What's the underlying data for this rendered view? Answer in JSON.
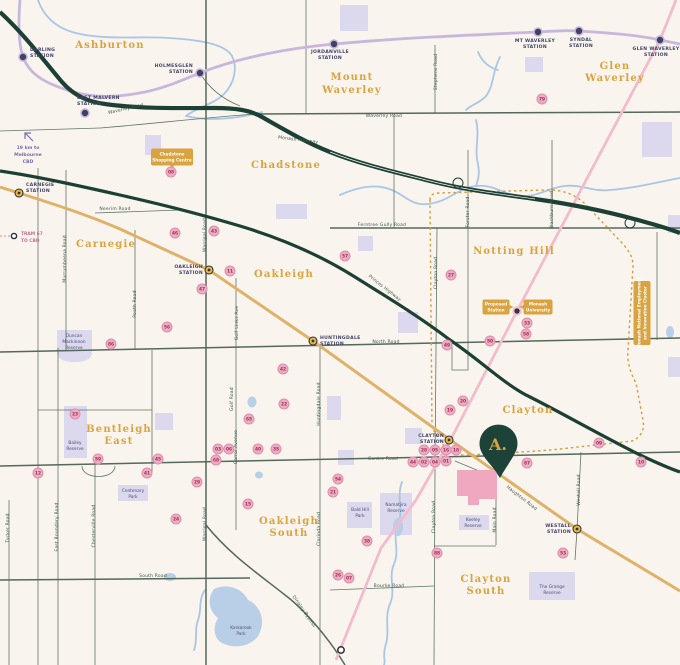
{
  "map": {
    "pin": {
      "label": "A."
    },
    "colors": {
      "background": "#f9f4ee",
      "freeway": "#1c4034",
      "minor_road": "#44604f",
      "gold_rail": "#dfb269",
      "purple_rail": "#c8b7db",
      "pink_line": "#f2bccd",
      "dotted_boundary": "#cf9e3d",
      "water": "#a9c7e5",
      "reserve": "#dcd8ed",
      "marker_fill": "#ecadc2",
      "marker_text": "#9e2f56",
      "badge": "#d9a340",
      "suburb_text": "#d9a43e",
      "station_text": "#3f4366",
      "pin_fill": "#1d4338"
    },
    "suburbs": [
      {
        "lines": [
          "Ashburton"
        ],
        "x": 110,
        "ys": [
          48
        ]
      },
      {
        "lines": [
          "Mount",
          "Waverley"
        ],
        "x": 352,
        "ys": [
          80,
          93
        ]
      },
      {
        "lines": [
          "Glen",
          "Waverley"
        ],
        "x": 615,
        "ys": [
          69,
          81
        ]
      },
      {
        "lines": [
          "Chadstone"
        ],
        "x": 286,
        "ys": [
          168
        ]
      },
      {
        "lines": [
          "Carnegie"
        ],
        "x": 106,
        "ys": [
          247
        ]
      },
      {
        "lines": [
          "Oakleigh"
        ],
        "x": 284,
        "ys": [
          277
        ]
      },
      {
        "lines": [
          "Notting Hill"
        ],
        "x": 514,
        "ys": [
          254
        ]
      },
      {
        "lines": [
          "Clayton"
        ],
        "x": 528,
        "ys": [
          413
        ]
      },
      {
        "lines": [
          "Bentleigh",
          "East"
        ],
        "x": 119,
        "ys": [
          432,
          444
        ]
      },
      {
        "lines": [
          "Oakleigh",
          "South"
        ],
        "x": 289,
        "ys": [
          524,
          536
        ]
      },
      {
        "lines": [
          "Clayton",
          "South"
        ],
        "x": 486,
        "ys": [
          582,
          594
        ]
      }
    ],
    "stations": [
      {
        "lines": [
          "DARLING",
          "STATION"
        ],
        "x": 23,
        "y": 57,
        "type": "purple",
        "anchor": "start",
        "lx": 30,
        "lys": [
          51,
          57
        ]
      },
      {
        "lines": [
          "EAST MALVERN",
          "STATION"
        ],
        "x": 85,
        "y": 113,
        "type": "purple",
        "anchor": "start",
        "lx": 77,
        "lys": [
          99,
          105
        ]
      },
      {
        "lines": [
          "HOLMESGLEN",
          "STATION"
        ],
        "x": 200,
        "y": 73,
        "type": "purple",
        "anchor": "end",
        "lx": 193,
        "lys": [
          67,
          73
        ]
      },
      {
        "lines": [
          "JORDANVILLE",
          "STATION"
        ],
        "x": 334,
        "y": 44,
        "type": "purple",
        "anchor": "middle",
        "lx": 330,
        "lys": [
          53,
          59
        ]
      },
      {
        "lines": [
          "MT WAVERLEY",
          "STATION"
        ],
        "x": 538,
        "y": 32,
        "type": "purple",
        "anchor": "middle",
        "lx": 535,
        "lys": [
          42,
          48
        ]
      },
      {
        "lines": [
          "SYNDAL",
          "STATION"
        ],
        "x": 579,
        "y": 31,
        "type": "purple",
        "anchor": "middle",
        "lx": 581,
        "lys": [
          41,
          47
        ]
      },
      {
        "lines": [
          "GLEN WAVERLEY",
          "STATION"
        ],
        "x": 660,
        "y": 40,
        "type": "purple",
        "anchor": "middle",
        "lx": 656,
        "lys": [
          50,
          56
        ]
      },
      {
        "lines": [
          "CARNEGIE",
          "STATION"
        ],
        "x": 19,
        "y": 193,
        "type": "gold",
        "anchor": "start",
        "lx": 26,
        "lys": [
          186,
          192
        ]
      },
      {
        "lines": [
          "OAKLEIGH",
          "STATION"
        ],
        "x": 209,
        "y": 270,
        "type": "gold",
        "anchor": "end",
        "lx": 203,
        "lys": [
          268,
          274
        ]
      },
      {
        "lines": [
          "HUNTINGDALE",
          "STATION"
        ],
        "x": 313,
        "y": 341,
        "type": "gold",
        "anchor": "start",
        "lx": 320,
        "lys": [
          339,
          345
        ]
      },
      {
        "lines": [
          "CLAYTON",
          "STATION"
        ],
        "x": 449,
        "y": 440,
        "type": "gold",
        "anchor": "end",
        "lx": 444,
        "lys": [
          437,
          443
        ]
      },
      {
        "lines": [
          "WESTALL",
          "STATION"
        ],
        "x": 577,
        "y": 529,
        "type": "gold",
        "anchor": "end",
        "lx": 571,
        "lys": [
          527,
          533
        ]
      },
      {
        "lines": [],
        "x": 517,
        "y": 311,
        "type": "proposed",
        "anchor": "start",
        "lx": 0,
        "lys": []
      }
    ],
    "badges": [
      {
        "lines": [
          "Chadstone",
          "Shopping Centre"
        ],
        "cx": 172,
        "cy": 157,
        "w": 42,
        "h": 17,
        "vertical": false,
        "pointer": "down"
      },
      {
        "lines": [
          "Proposed",
          "Station"
        ],
        "cx": 496,
        "cy": 307,
        "w": 27,
        "h": 15,
        "vertical": false,
        "pointer": "right"
      },
      {
        "lines": [
          "Monash",
          "University"
        ],
        "cx": 538,
        "cy": 307,
        "w": 29,
        "h": 15,
        "vertical": false,
        "pointer": "left"
      },
      {
        "lines": [
          "Monash National Employment",
          "and Innovation Cluster"
        ],
        "cx": 642,
        "cy": 313,
        "w": 64,
        "h": 17,
        "vertical": true,
        "pointer": "none"
      }
    ],
    "road_labels": [
      {
        "t": "Waverley Road",
        "x": 126,
        "y": 110,
        "r": -13
      },
      {
        "t": "Waverley Road",
        "x": 384,
        "y": 117,
        "r": 0
      },
      {
        "t": "Monash Freeway",
        "x": 298,
        "y": 141,
        "r": 7
      },
      {
        "t": "Stephens Road",
        "x": 437,
        "y": 72,
        "r": -90
      },
      {
        "t": "Neerim Road",
        "x": 115,
        "y": 210,
        "r": 0
      },
      {
        "t": "Murrumbeena Road",
        "x": 66,
        "y": 259,
        "r": -90
      },
      {
        "t": "Poath Road",
        "x": 136,
        "y": 304,
        "r": -90
      },
      {
        "t": "Warrigal Road",
        "x": 206,
        "y": 235,
        "r": -90
      },
      {
        "t": "Warrigal Road",
        "x": 206,
        "y": 524,
        "r": -90
      },
      {
        "t": "Golf Links Ave",
        "x": 238,
        "y": 323,
        "r": -90
      },
      {
        "t": "Golf Road",
        "x": 233,
        "y": 399,
        "r": -90
      },
      {
        "t": "Carrol Avenue",
        "x": 237,
        "y": 447,
        "r": -90
      },
      {
        "t": "Ferntree Gully Road",
        "x": 382,
        "y": 226,
        "r": 0
      },
      {
        "t": "Forster Road",
        "x": 469,
        "y": 212,
        "r": -90
      },
      {
        "t": "Blackburn Road",
        "x": 553,
        "y": 210,
        "r": -90
      },
      {
        "t": "Clayton Road",
        "x": 437,
        "y": 273,
        "r": -90
      },
      {
        "t": "Clayton Road",
        "x": 435,
        "y": 517,
        "r": -90
      },
      {
        "t": "Princes Highway",
        "x": 384,
        "y": 289,
        "r": 38
      },
      {
        "t": "North Road",
        "x": 386,
        "y": 343,
        "r": 0
      },
      {
        "t": "Huntingdale Road",
        "x": 320,
        "y": 404,
        "r": -90
      },
      {
        "t": "Centre Road",
        "x": 383,
        "y": 460,
        "r": 0
      },
      {
        "t": "Haughton Road",
        "x": 521,
        "y": 499,
        "r": 38
      },
      {
        "t": "Main Road",
        "x": 496,
        "y": 520,
        "r": -90
      },
      {
        "t": "Westall Road",
        "x": 580,
        "y": 490,
        "r": -90
      },
      {
        "t": "Bourke Road",
        "x": 389,
        "y": 587,
        "r": 0
      },
      {
        "t": "South Road",
        "x": 153,
        "y": 577,
        "r": 0
      },
      {
        "t": "Tucker Road",
        "x": 9,
        "y": 528,
        "r": -90
      },
      {
        "t": "East Boundary Road",
        "x": 58,
        "y": 527,
        "r": -90
      },
      {
        "t": "Chesterville Road",
        "x": 95,
        "y": 526,
        "r": -90
      },
      {
        "t": "Clarinda Road",
        "x": 320,
        "y": 529,
        "r": -90
      },
      {
        "t": "Dingley Bypass",
        "x": 303,
        "y": 612,
        "r": 55
      }
    ],
    "reserves": [
      {
        "lines": [
          "Duncan",
          "Mackinnon",
          "Reserve"
        ],
        "x": 74,
        "ys": [
          337,
          343,
          349
        ]
      },
      {
        "lines": [
          "Bailey",
          "Reserve"
        ],
        "x": 75,
        "ys": [
          444,
          450
        ]
      },
      {
        "lines": [
          "Centenary",
          "Park"
        ],
        "x": 133,
        "ys": [
          492,
          498
        ]
      },
      {
        "lines": [
          "Karkarook",
          "Park"
        ],
        "x": 241,
        "ys": [
          629,
          635
        ]
      },
      {
        "lines": [
          "Bald Hill",
          "Park"
        ],
        "x": 360,
        "ys": [
          511,
          517
        ]
      },
      {
        "lines": [
          "Namatjira",
          "Reserve"
        ],
        "x": 396,
        "ys": [
          506,
          512
        ]
      },
      {
        "lines": [
          "Keeley",
          "Reserve"
        ],
        "x": 473,
        "ys": [
          521,
          527
        ]
      },
      {
        "lines": [
          "The Grange",
          "Reserve"
        ],
        "x": 552,
        "ys": [
          588,
          594
        ]
      }
    ],
    "notes": {
      "cbd": {
        "lines": [
          "19 km to",
          "Melbourne",
          "CBD"
        ],
        "x": 28,
        "ys": [
          149,
          156,
          163
        ]
      },
      "tram": {
        "lines": [
          "TRAM 67",
          "TO CBD"
        ],
        "x": 21,
        "ys": [
          235,
          242
        ]
      }
    },
    "markers": [
      {
        "n": "08",
        "x": 171,
        "y": 172
      },
      {
        "n": "79",
        "x": 542,
        "y": 99
      },
      {
        "n": "46",
        "x": 175,
        "y": 233
      },
      {
        "n": "43",
        "x": 214,
        "y": 231
      },
      {
        "n": "11",
        "x": 230,
        "y": 271
      },
      {
        "n": "47",
        "x": 202,
        "y": 289
      },
      {
        "n": "56",
        "x": 167,
        "y": 327
      },
      {
        "n": "86",
        "x": 111,
        "y": 344
      },
      {
        "n": "57",
        "x": 345,
        "y": 256
      },
      {
        "n": "27",
        "x": 451,
        "y": 275
      },
      {
        "n": "33",
        "x": 527,
        "y": 323
      },
      {
        "n": "58",
        "x": 526,
        "y": 334
      },
      {
        "n": "50",
        "x": 490,
        "y": 341
      },
      {
        "n": "49",
        "x": 447,
        "y": 345
      },
      {
        "n": "42",
        "x": 283,
        "y": 369
      },
      {
        "n": "22",
        "x": 284,
        "y": 404
      },
      {
        "n": "65",
        "x": 249,
        "y": 419
      },
      {
        "n": "23",
        "x": 75,
        "y": 414
      },
      {
        "n": "59",
        "x": 98,
        "y": 459
      },
      {
        "n": "45",
        "x": 158,
        "y": 459
      },
      {
        "n": "03",
        "x": 218,
        "y": 449
      },
      {
        "n": "06",
        "x": 229,
        "y": 449
      },
      {
        "n": "68",
        "x": 216,
        "y": 460
      },
      {
        "n": "40",
        "x": 258,
        "y": 449
      },
      {
        "n": "35",
        "x": 276,
        "y": 449
      },
      {
        "n": "12",
        "x": 38,
        "y": 473
      },
      {
        "n": "41",
        "x": 147,
        "y": 473
      },
      {
        "n": "29",
        "x": 197,
        "y": 482
      },
      {
        "n": "24",
        "x": 176,
        "y": 519
      },
      {
        "n": "15",
        "x": 248,
        "y": 504
      },
      {
        "n": "21",
        "x": 333,
        "y": 492
      },
      {
        "n": "54",
        "x": 338,
        "y": 479
      },
      {
        "n": "38",
        "x": 367,
        "y": 541
      },
      {
        "n": "26",
        "x": 338,
        "y": 575
      },
      {
        "n": "07",
        "x": 349,
        "y": 578
      },
      {
        "n": "88",
        "x": 437,
        "y": 553
      },
      {
        "n": "53",
        "x": 563,
        "y": 553
      },
      {
        "n": "09",
        "x": 599,
        "y": 443
      },
      {
        "n": "10",
        "x": 641,
        "y": 462
      },
      {
        "n": "19",
        "x": 450,
        "y": 410
      },
      {
        "n": "20",
        "x": 463,
        "y": 401
      },
      {
        "n": "87",
        "x": 527,
        "y": 463
      },
      {
        "n": "28",
        "x": 424,
        "y": 450
      },
      {
        "n": "05",
        "x": 435,
        "y": 450
      },
      {
        "n": "16",
        "x": 446,
        "y": 450
      },
      {
        "n": "18",
        "x": 456,
        "y": 450
      },
      {
        "n": "44",
        "x": 413,
        "y": 462
      },
      {
        "n": "02",
        "x": 424,
        "y": 462
      },
      {
        "n": "04",
        "x": 435,
        "y": 462
      },
      {
        "n": "01",
        "x": 446,
        "y": 461
      }
    ]
  }
}
